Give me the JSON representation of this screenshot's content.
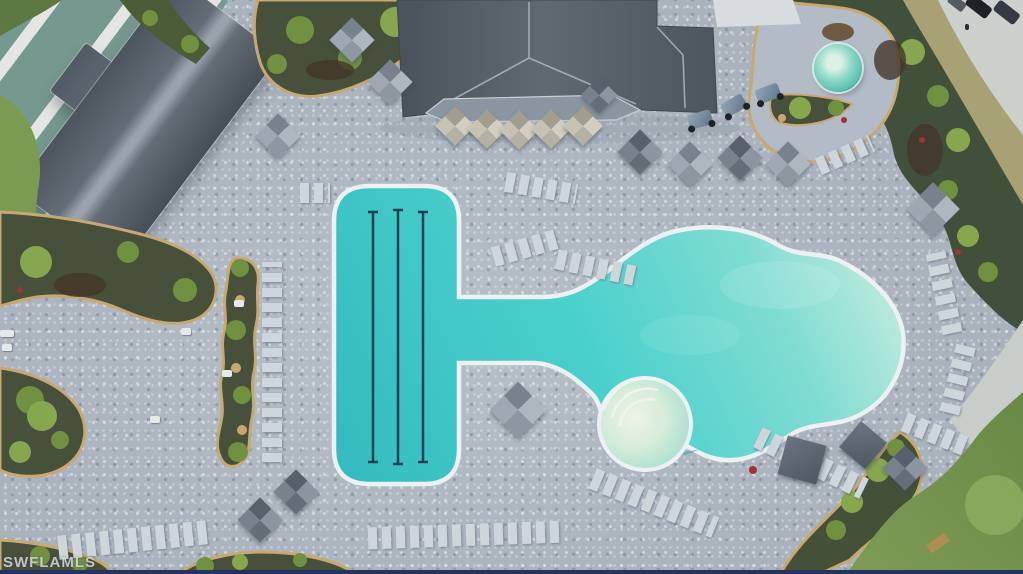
{
  "image": {
    "kind": "aerial-drone-photograph",
    "subject": "resort-style community pool amenity area, top-down view"
  },
  "watermark": {
    "text": "SWFLAMLS"
  },
  "palette": {
    "deck": "#a9b2bd",
    "deck-light": "#c7ced6",
    "deck-dark": "#8a94a0",
    "water": "#3fc9c6",
    "water-deep": "#2fb0b6",
    "water-shallow": "#cdeede",
    "coping": "#edf1f3",
    "lane-line": "#1e4152",
    "roof": "#5c6570",
    "roof-light": "#a2abb5",
    "roof-dark": "#49515b",
    "veranda": "#8b95a1",
    "umbrella-beige": "#c9c4b6",
    "umbrella-gray": "#9aa4af",
    "umbrella-dark": "#6e7984",
    "chair": "#ced5db",
    "cabana": "#5a6572",
    "bed": "#46503a",
    "mulch": "#43362a",
    "plant": "#5f7f3c",
    "plant-light": "#87a74f",
    "sand": "#c9a86f",
    "grass": "#7b9a52",
    "grass-dark": "#5c7a40",
    "grass-dry": "#a8a173",
    "road": "#cdd1cd",
    "car": "#23272e",
    "spa-rim": "#2d9189",
    "spa-water": "#8ad8c7",
    "watermark": "#d6dade",
    "frame": "#23355c"
  },
  "features": [
    "lap-pool-with-three-lane-lines",
    "freeform-resort-pool",
    "connecting-channel",
    "beach-entry-steps",
    "round-spa",
    "clubhouse-hip-roof",
    "secondary-building-roof",
    "bocce-courts",
    "paver-pool-deck",
    "lounge-chair-rows",
    "shade-umbrellas",
    "cabanas",
    "landscape-beds-with-palms",
    "road-with-parked-cars",
    "lawn-areas"
  ]
}
